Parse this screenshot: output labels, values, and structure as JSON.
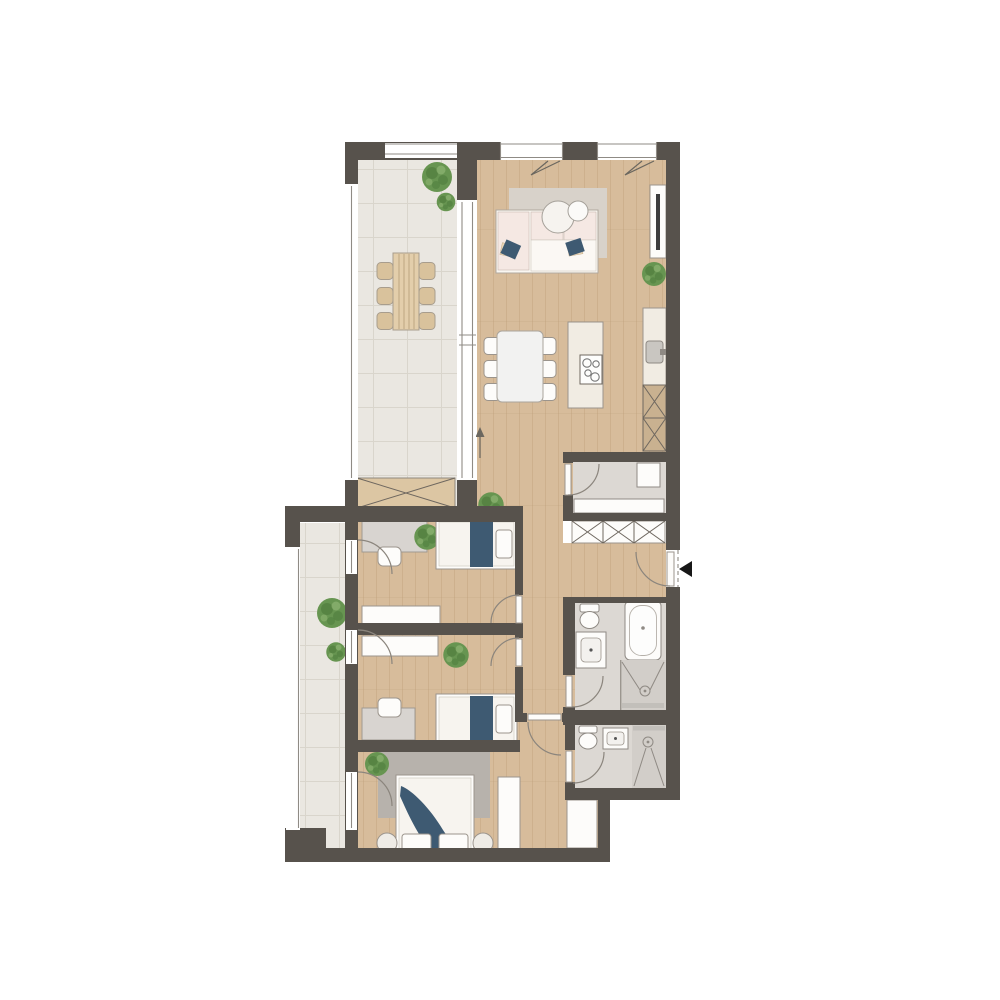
{
  "title": "apartment-floor-plan",
  "colors": {
    "bg": "#ffffff",
    "wall": "#57524C",
    "wood": "#D7BC9B",
    "wood_line": "#B99A72",
    "tile_out": "#EAE7E1",
    "tile_grid": "#D9D5CC",
    "tile_bath": "#DCD8D3",
    "tile_shower": "#D2CEC9",
    "furn_white": "#FDFCFA",
    "furn_border": "#9B948C",
    "cream": "#F1ECE3",
    "cab_tan": "#C9B190",
    "wood_furn": "#E3CEAB",
    "wood_furn2": "#D9C29C",
    "pink": "#F5E8E3",
    "blue": "#3E5A72",
    "rug": "#D8D2CA",
    "rug_dark": "#B7B2AC",
    "green1": "#679551",
    "green2": "#4A7739",
    "green3": "#8FB573",
    "arc_color": "#8B857D",
    "glass": "#8F8B85",
    "xline": "#6E675F",
    "tv_dark": "#3C3C3C",
    "appliance_grey": "#C9C6C1",
    "entrance_marker": "#171717"
  },
  "legend": {
    "entrance_marker": "black-triangle-arrow",
    "north_arrow": "up-arrow",
    "wardrobe_symbol": "crossed-box",
    "door_symbol": "quarter-arc-swing"
  },
  "rooms": [
    {
      "id": "terrace",
      "floor": "tile",
      "items": [
        {
          "item": "outdoor-dining-table",
          "count": 1
        },
        {
          "item": "outdoor-chair",
          "count": 6
        },
        {
          "item": "plant",
          "count": 2
        },
        {
          "item": "storage-bench",
          "count": 1
        },
        {
          "item": "railing",
          "count": 2
        }
      ]
    },
    {
      "id": "living-dining-kitchen",
      "floor": "wood",
      "items": [
        {
          "item": "corner-sofa",
          "count": 1
        },
        {
          "item": "throw-pillow",
          "count": 2
        },
        {
          "item": "area-rug",
          "count": 1
        },
        {
          "item": "round-coffee-table",
          "count": 2
        },
        {
          "item": "tv-sideboard",
          "count": 1
        },
        {
          "item": "dining-table",
          "count": 1
        },
        {
          "item": "dining-chair",
          "count": 6
        },
        {
          "item": "kitchen-island-with-cooktop",
          "count": 1
        },
        {
          "item": "kitchen-counter-with-sink",
          "count": 1
        },
        {
          "item": "tall-cabinet",
          "count": 2
        },
        {
          "item": "plant",
          "count": 2
        },
        {
          "item": "window",
          "count": 2
        },
        {
          "item": "glazed-wall-to-terrace",
          "count": 1
        },
        {
          "item": "north-arrow",
          "count": 1
        }
      ]
    },
    {
      "id": "hallway",
      "floor": "wood",
      "items": [
        {
          "item": "wardrobe-crossed",
          "count": 3
        },
        {
          "item": "entrance-door",
          "count": 1
        },
        {
          "item": "plant",
          "count": 1
        }
      ]
    },
    {
      "id": "utility-room",
      "floor": "tile",
      "items": [
        {
          "item": "washing-machine",
          "count": 1
        },
        {
          "item": "counter",
          "count": 1
        },
        {
          "item": "door",
          "count": 1
        }
      ]
    },
    {
      "id": "bathroom-main",
      "floor": "tile",
      "items": [
        {
          "item": "bathtub",
          "count": 1
        },
        {
          "item": "shower",
          "count": 1
        },
        {
          "item": "vanity-sink",
          "count": 1
        },
        {
          "item": "toilet",
          "count": 1
        },
        {
          "item": "door",
          "count": 1
        }
      ]
    },
    {
      "id": "shower-room",
      "floor": "tile",
      "items": [
        {
          "item": "shower",
          "count": 1
        },
        {
          "item": "sink",
          "count": 1
        },
        {
          "item": "toilet",
          "count": 1
        },
        {
          "item": "door",
          "count": 1
        }
      ]
    },
    {
      "id": "bedroom-1",
      "floor": "wood",
      "items": [
        {
          "item": "single-bed",
          "count": 1
        },
        {
          "item": "desk",
          "count": 1
        },
        {
          "item": "chair",
          "count": 1
        },
        {
          "item": "wardrobe",
          "count": 1
        },
        {
          "item": "plant",
          "count": 1
        },
        {
          "item": "balcony-door",
          "count": 1
        },
        {
          "item": "door",
          "count": 1
        }
      ]
    },
    {
      "id": "bedroom-2",
      "floor": "wood",
      "items": [
        {
          "item": "single-bed",
          "count": 1
        },
        {
          "item": "desk",
          "count": 1
        },
        {
          "item": "chair",
          "count": 1
        },
        {
          "item": "wardrobe",
          "count": 1
        },
        {
          "item": "plant",
          "count": 1
        },
        {
          "item": "balcony-door",
          "count": 1
        },
        {
          "item": "door",
          "count": 1
        }
      ]
    },
    {
      "id": "master-bedroom",
      "floor": "wood",
      "items": [
        {
          "item": "double-bed",
          "count": 1
        },
        {
          "item": "pillow",
          "count": 2
        },
        {
          "item": "round-nightstand",
          "count": 2
        },
        {
          "item": "area-rug",
          "count": 1
        },
        {
          "item": "wardrobe",
          "count": 2
        },
        {
          "item": "plant",
          "count": 1
        },
        {
          "item": "balcony-door",
          "count": 1
        },
        {
          "item": "door",
          "count": 1
        }
      ]
    },
    {
      "id": "balcony",
      "floor": "tile",
      "items": [
        {
          "item": "plant",
          "count": 2
        },
        {
          "item": "railing",
          "count": 1
        }
      ]
    }
  ]
}
